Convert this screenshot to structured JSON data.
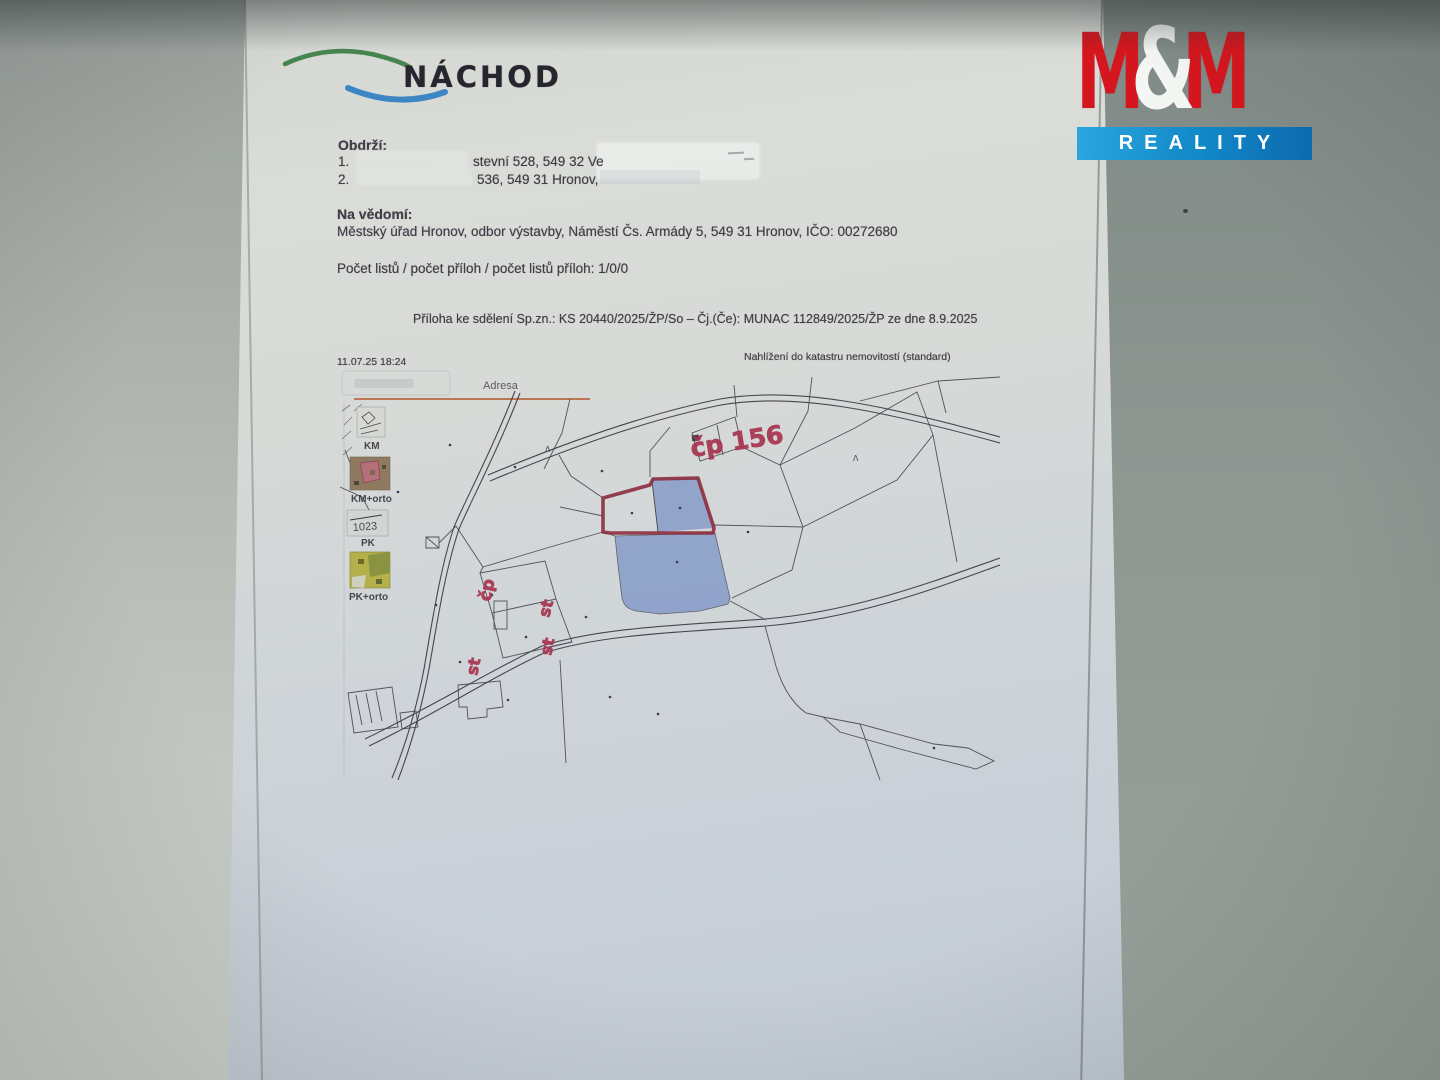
{
  "letter": {
    "logo_text": "NÁCHOD",
    "recipients_heading": "Obdrží:",
    "recipient1_num": "1.",
    "recipient1_text": "stevní 528, 549 32 Ve",
    "recipient2_num": "2.",
    "recipient2_text": "536, 549 31 Hronov,",
    "fyi_heading": "Na vědomí:",
    "fyi_line": "Městský úřad Hronov, odbor výstavby, Náměstí Čs. Armády 5, 549 31 Hronov, IČO: 00272680",
    "counts_line": "Počet listů / počet příloh / počet listů příloh: 1/0/0",
    "attachment_line": "Příloha ke sdělení Sp.zn.: KS 20440/2025/ŽP/So – Čj.(Če): MUNAC 112849/2025/ŽP ze dne  8.9.2025"
  },
  "map": {
    "timestamp": "11.07.25 18:24",
    "title": "Nahlížení do katastru nemovitostí (standard)",
    "tab_label": "Adresa",
    "layer_km": "KM",
    "layer_km_orto": "KM+orto",
    "layer_pk": "PK",
    "layer_pk_orto": "PK+orto",
    "pk_thumb_note": "1023",
    "tree_symbol": "Λ",
    "ann_cp156": "čp 156",
    "ann_cp": "čp",
    "ann_st1": "st",
    "ann_st2": "st",
    "ann_st3": "st"
  },
  "watermark": {
    "m1": "M",
    "amp": "&",
    "m2": "M",
    "reality": "REALITY"
  },
  "colors": {
    "mm_red": "#d6161e",
    "mm_blue_bar": "#1187c6",
    "annotation_red": "#a8354f",
    "parcel_fill_blue": "#8096c7",
    "parcel_outline_red": "#8c2e3d",
    "logo_green": "#3a7d44",
    "logo_blue": "#2f7fc1",
    "paper": "#d5d8d5",
    "wall": "#8e9792"
  }
}
